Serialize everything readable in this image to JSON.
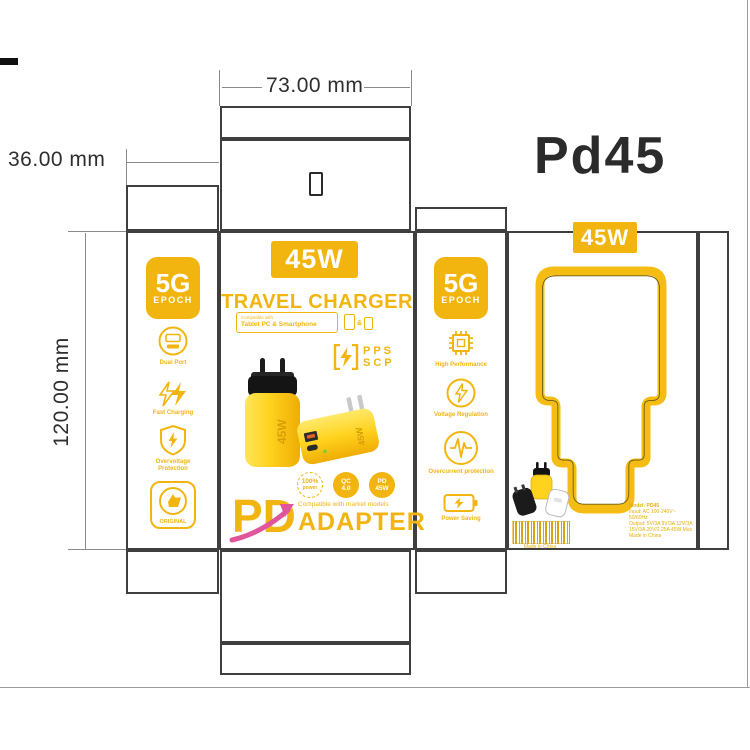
{
  "artboard": {
    "product_code": "Pd45"
  },
  "dimensions": {
    "width": "73.00 mm",
    "depth": "36.00 mm",
    "height": "120.00 mm"
  },
  "colors": {
    "yellow": "#F2B50F",
    "yellow_bright": "#FFD21E",
    "magenta": "#E0559B",
    "cut_line": "#3F3F3F"
  },
  "front": {
    "wattage": "45W",
    "title": "TRAVEL CHARGER",
    "compatible_label": "Compatible with",
    "compatible_value": "Tablet PC & Smartphone",
    "compatible_amp": "&",
    "pps": "PPS",
    "scp": "SCP",
    "charger_marking": "45W",
    "badges": [
      {
        "line1": "100%",
        "line2": "power"
      },
      {
        "line1": "QC",
        "line2": "4.0"
      },
      {
        "line1": "PD",
        "line2": "45W"
      }
    ],
    "pd": "PD",
    "adapter_note": "Compatible with market models",
    "adapter": "ADAPTER"
  },
  "side_left": {
    "badge": {
      "line1": "5G",
      "line2": "EPOCH"
    },
    "features": [
      {
        "icon": "dual-port-icon",
        "label": "Dual Port"
      },
      {
        "icon": "fast-charging-icon",
        "label": "Fast Charging"
      },
      {
        "icon": "overvoltage-icon",
        "label": "Overvoltage Protection"
      },
      {
        "icon": "original-icon",
        "label": "ORIGINAL"
      }
    ]
  },
  "side_right": {
    "badge": {
      "line1": "5G",
      "line2": "EPOCH"
    },
    "features": [
      {
        "icon": "chip-icon",
        "label": "High Performance"
      },
      {
        "icon": "voltage-regulation-icon",
        "label": "Voltage Regulation"
      },
      {
        "icon": "overcurrent-icon",
        "label": "Overcurrent protection"
      },
      {
        "icon": "power-saving-icon",
        "label": "Power Saving"
      }
    ]
  },
  "back": {
    "wattage": "45W",
    "barcode_caption": "Made in China",
    "spec_lines": [
      "Model: PD45",
      "Input: AC 100-240V~ 50/60Hz",
      "Output: 5V/3A 9V/3A 12V/3A",
      "15V/3A 20V/2.25A 45W Max",
      "Made in China"
    ]
  }
}
